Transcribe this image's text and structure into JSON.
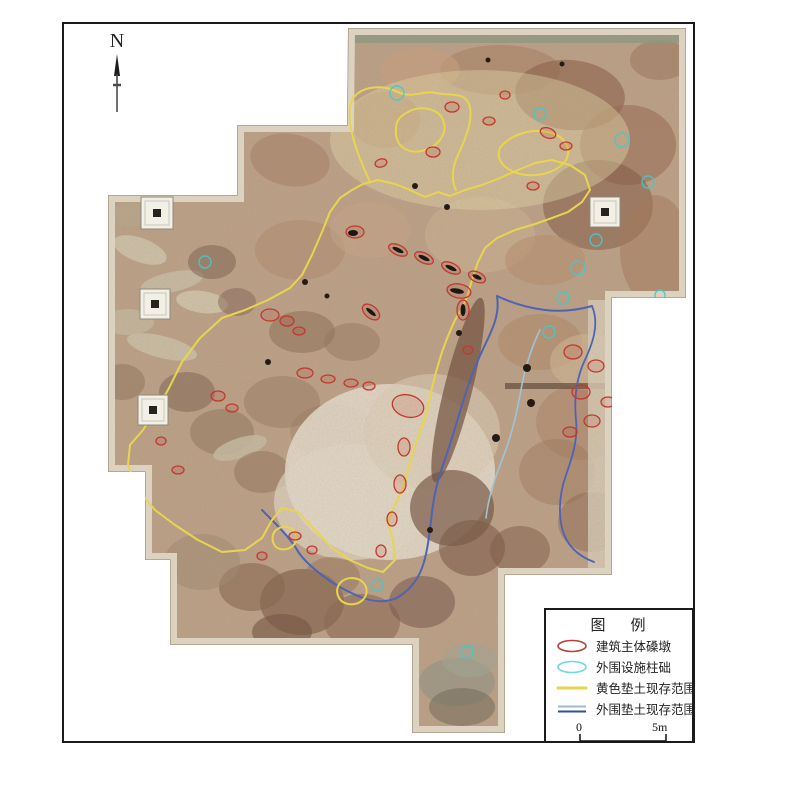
{
  "north": {
    "label": "N"
  },
  "legend": {
    "title": "图    例",
    "items": [
      {
        "name": "main-pier",
        "label": "建筑主体磉墩",
        "symbol": "ellipse",
        "stroke": "#b5413a"
      },
      {
        "name": "peripheral-column-base",
        "label": "外围设施柱础",
        "symbol": "ellipse",
        "stroke": "#6fd8dc"
      },
      {
        "name": "yellow-fill-extent",
        "label": "黄色垫土现存范围",
        "symbol": "line",
        "stroke": "#e8d44f"
      },
      {
        "name": "outer-fill-extent",
        "label": "外围垫土现存范围",
        "symbol": "double-line",
        "stroke": "#2d4f9e",
        "stroke2": "#9fb8cc"
      }
    ],
    "scale_start": "0",
    "scale_end": "5m"
  },
  "map": {
    "clip": "348,28 686,28 686,298 612,298 612,575 505,575 505,733 412,733 412,645 170,645 170,560 145,560 145,472 108,472 108,195 237,195 237,125 347,125",
    "base_fill": "#bda189",
    "edge_light": "#dcd2bf",
    "edge_dark": "#a79a83",
    "yellow": "#e8d44f",
    "red": "#c0392f",
    "cyan": "#45c8cc",
    "blobs": [
      [
        500,
        70,
        60,
        25,
        0,
        "#a87f61",
        0.55
      ],
      [
        570,
        95,
        55,
        35,
        5,
        "#8a5f48",
        0.6
      ],
      [
        628,
        145,
        48,
        40,
        0,
        "#97684e",
        0.55
      ],
      [
        598,
        205,
        55,
        45,
        0,
        "#7c523e",
        0.5
      ],
      [
        655,
        250,
        35,
        55,
        0,
        "#a37757",
        0.5
      ],
      [
        480,
        235,
        55,
        38,
        0,
        "#cbb391",
        0.6
      ],
      [
        420,
        70,
        40,
        22,
        0,
        "#c9a07e",
        0.6
      ],
      [
        385,
        120,
        35,
        28,
        0,
        "#b78a68",
        0.5
      ],
      [
        545,
        260,
        40,
        25,
        0,
        "#b68c6a",
        0.5
      ],
      [
        660,
        60,
        30,
        20,
        0,
        "#9a7258",
        0.5
      ],
      [
        290,
        160,
        40,
        26,
        10,
        "#a58064",
        0.55
      ],
      [
        140,
        250,
        28,
        12,
        20,
        "#cfc4ad",
        0.9
      ],
      [
        172,
        282,
        32,
        10,
        -12,
        "#c9bda6",
        0.9
      ],
      [
        202,
        302,
        26,
        11,
        8,
        "#d2c6ae",
        0.9
      ],
      [
        128,
        322,
        26,
        13,
        0,
        "#c4b79e",
        0.9
      ],
      [
        162,
        347,
        36,
        11,
        14,
        "#ccc0a8",
        0.9
      ],
      [
        212,
        262,
        24,
        17,
        0,
        "#7e6450",
        0.55
      ],
      [
        237,
        302,
        19,
        14,
        0,
        "#86695a",
        0.55
      ],
      [
        122,
        382,
        23,
        18,
        0,
        "#8a7158",
        0.5
      ],
      [
        187,
        392,
        28,
        20,
        0,
        "#79604e",
        0.5
      ],
      [
        222,
        432,
        32,
        23,
        0,
        "#8a6e57",
        0.45
      ],
      [
        240,
        448,
        28,
        10,
        -18,
        "#c8bca4",
        0.85
      ],
      [
        130,
        215,
        20,
        12,
        0,
        "#b7a78e",
        0.8
      ],
      [
        302,
        332,
        33,
        21,
        0,
        "#8a6a52",
        0.5
      ],
      [
        352,
        342,
        28,
        19,
        0,
        "#93745c",
        0.45
      ],
      [
        282,
        402,
        38,
        26,
        0,
        "#8f7058",
        0.4
      ],
      [
        332,
        432,
        42,
        28,
        0,
        "#97785f",
        0.35
      ],
      [
        262,
        472,
        28,
        21,
        0,
        "#8a6b54",
        0.45
      ],
      [
        390,
        472,
        105,
        88,
        0,
        "#e7ded0",
        0.85
      ],
      [
        352,
        502,
        78,
        58,
        0,
        "#e2d8c8",
        0.7
      ],
      [
        432,
        432,
        68,
        58,
        0,
        "#dccfb8",
        0.6
      ],
      [
        300,
        250,
        45,
        30,
        0,
        "#b08a6c",
        0.5
      ],
      [
        370,
        230,
        40,
        28,
        0,
        "#c7a887",
        0.5
      ],
      [
        458,
        390,
        14,
        95,
        14,
        "#6d4b3a",
        0.7
      ],
      [
        452,
        508,
        42,
        38,
        0,
        "#6f4e3c",
        0.65
      ],
      [
        472,
        548,
        33,
        28,
        0,
        "#7a5846",
        0.6
      ],
      [
        302,
        602,
        42,
        33,
        0,
        "#7d5c48",
        0.65
      ],
      [
        362,
        622,
        38,
        28,
        0,
        "#8a6752",
        0.6
      ],
      [
        252,
        587,
        33,
        24,
        0,
        "#86654f",
        0.6
      ],
      [
        422,
        602,
        33,
        26,
        0,
        "#77564a",
        0.55
      ],
      [
        332,
        577,
        28,
        20,
        0,
        "#94735a",
        0.5
      ],
      [
        202,
        562,
        38,
        28,
        0,
        "#a08a71",
        0.5
      ],
      [
        282,
        632,
        30,
        18,
        0,
        "#6f5240",
        0.6
      ],
      [
        540,
        342,
        42,
        28,
        0,
        "#b08663",
        0.5
      ],
      [
        582,
        422,
        46,
        38,
        0,
        "#a97f60",
        0.45
      ],
      [
        557,
        472,
        38,
        33,
        0,
        "#9c7458",
        0.4
      ],
      [
        592,
        522,
        34,
        30,
        0,
        "#8d6750",
        0.5
      ],
      [
        588,
        362,
        38,
        28,
        0,
        "#d3bb97",
        0.55
      ],
      [
        520,
        550,
        30,
        24,
        0,
        "#7b5a46",
        0.5
      ],
      [
        457,
        682,
        38,
        24,
        0,
        "#8f9486",
        0.6
      ],
      [
        462,
        707,
        33,
        19,
        0,
        "#6f6a58",
        0.55
      ],
      [
        470,
        660,
        28,
        17,
        0,
        "#a3a896",
        0.55
      ],
      [
        480,
        140,
        150,
        70,
        0,
        "#e3d6a8",
        0.45
      ]
    ],
    "rects": [
      [
        348,
        28,
        338,
        15,
        "#8f9a85",
        0.8
      ],
      [
        505,
        383,
        106,
        6,
        "#5f4636",
        0.7
      ],
      [
        588,
        300,
        24,
        272,
        "#d9cfbc",
        0.8
      ]
    ],
    "yellow_paths": [
      "M352,190 L340,198 L330,212 L322,232 L312,255 L302,275 L290,288 L268,300 L245,310 L222,318 L200,338 L182,362 L168,390 L153,415 L143,430 L130,445 L128,465 L138,490 L155,510 L175,525 L198,540 L222,552 L245,550 L262,538 L272,520 L282,508 L298,512 L315,530 L332,548 L350,560 L368,568 L383,572 L395,560 L393,540 L388,522 L395,505 L403,488 L408,470 L413,452 L420,432 L427,412 L431,392 L436,372 L442,352 L448,336 L455,320 L462,308 L467,297 L472,280 L478,262 L485,248 L497,238 L515,230 L535,224 L552,218 L568,212 L582,202 L590,190 L585,175 L570,165 L552,160 L535,163 L518,170 L500,178 L482,185 L465,190 L450,196 L438,192 L425,197 L410,190 L395,184 L378,180 L363,184 Z",
      "M370,182 C355,150 345,118 352,100 C360,86 382,84 398,92 C412,99 422,90 436,93 C452,96 464,92 469,104 C474,118 466,138 458,155 C451,170 452,182 456,190",
      "M408,112 C420,105 438,108 443,120 C448,132 440,145 425,150 C410,155 398,148 396,135 C395,122 398,117 408,112 Z",
      "M500,148 C510,135 530,128 548,132 C565,136 572,148 566,160 C558,172 538,178 520,174 C505,170 495,160 500,148 Z",
      "M340,583 C348,575 362,577 366,587 C369,597 360,606 348,604 C338,602 334,591 340,583 Z",
      "M276,530 C284,524 294,527 296,535 C298,544 290,551 280,549 C272,547 270,536 276,530 Z"
    ],
    "blue_paths": [
      {
        "d": "M497,296 C500,315 492,330 485,345 C475,365 468,385 462,405 C456,425 450,445 444,462 C438,478 434,495 432,512 C430,530 428,548 424,562 C420,576 412,588 400,596 C388,604 372,602 358,596 C344,590 330,582 318,572 C308,564 300,556 296,548 C288,536 276,524 262,510",
        "color": "#4f63b5",
        "w": 2
      },
      {
        "d": "M497,296 C512,303 528,308 545,310 C562,312 578,310 592,306",
        "color": "#4f63b5",
        "w": 2
      },
      {
        "d": "M592,306 C600,325 592,345 584,362 C576,380 574,400 576,420 C578,440 572,458 566,475 C560,492 558,510 562,528 C566,545 578,556 594,562",
        "color": "#4f63b5",
        "w": 1.8
      },
      {
        "d": "M540,330 C530,350 524,372 520,395 C516,418 510,440 502,460 C494,480 488,500 486,518",
        "color": "#9fc4d6",
        "w": 1.6
      }
    ],
    "red_ellipses": [
      [
        452,
        107,
        7,
        5,
        0
      ],
      [
        489,
        121,
        6,
        4,
        0
      ],
      [
        548,
        133,
        8,
        5,
        20
      ],
      [
        566,
        146,
        6,
        4,
        0
      ],
      [
        433,
        152,
        7,
        5,
        0
      ],
      [
        381,
        163,
        6,
        4,
        -15
      ],
      [
        355,
        232,
        9,
        6,
        0
      ],
      [
        398,
        250,
        10,
        5,
        25
      ],
      [
        424,
        258,
        10,
        5,
        25
      ],
      [
        451,
        268,
        10,
        5,
        25
      ],
      [
        477,
        277,
        9,
        5,
        25
      ],
      [
        459,
        291,
        12,
        7,
        10
      ],
      [
        371,
        312,
        10,
        6,
        40
      ],
      [
        463,
        310,
        6,
        10,
        0
      ],
      [
        270,
        315,
        9,
        6,
        0
      ],
      [
        287,
        321,
        7,
        5,
        0
      ],
      [
        299,
        331,
        6,
        4,
        0
      ],
      [
        305,
        373,
        8,
        5,
        0
      ],
      [
        328,
        379,
        7,
        4,
        0
      ],
      [
        351,
        383,
        7,
        4,
        0
      ],
      [
        369,
        386,
        6,
        4,
        0
      ],
      [
        150,
        420,
        6,
        4,
        0
      ],
      [
        161,
        441,
        5,
        4,
        0
      ],
      [
        218,
        396,
        7,
        5,
        0
      ],
      [
        232,
        408,
        6,
        4,
        0
      ],
      [
        408,
        406,
        16,
        11,
        15
      ],
      [
        468,
        350,
        5,
        4,
        0
      ],
      [
        404,
        447,
        6,
        9,
        0
      ],
      [
        400,
        484,
        6,
        9,
        0
      ],
      [
        392,
        519,
        5,
        7,
        0
      ],
      [
        381,
        551,
        5,
        6,
        0
      ],
      [
        573,
        352,
        9,
        7,
        0
      ],
      [
        596,
        366,
        8,
        6,
        0
      ],
      [
        581,
        392,
        9,
        7,
        0
      ],
      [
        608,
        402,
        7,
        5,
        0
      ],
      [
        592,
        421,
        8,
        6,
        0
      ],
      [
        570,
        432,
        7,
        5,
        0
      ],
      [
        295,
        536,
        6,
        4,
        0
      ],
      [
        312,
        550,
        5,
        4,
        0
      ],
      [
        262,
        556,
        5,
        4,
        0
      ],
      [
        178,
        470,
        6,
        4,
        0
      ],
      [
        533,
        186,
        6,
        4,
        0
      ],
      [
        505,
        95,
        5,
        4,
        0
      ]
    ],
    "black_slots": [
      [
        398,
        250,
        6,
        2,
        25
      ],
      [
        424,
        258,
        6,
        2,
        25
      ],
      [
        451,
        268,
        6,
        2,
        25
      ],
      [
        477,
        277,
        5,
        2,
        25
      ],
      [
        457,
        291,
        7,
        2.5,
        10
      ],
      [
        371,
        312,
        6,
        2,
        40
      ],
      [
        463,
        310,
        2.5,
        6,
        0
      ],
      [
        353,
        233,
        5,
        3,
        0
      ]
    ],
    "black_dots": [
      [
        415,
        186,
        3
      ],
      [
        447,
        207,
        3
      ],
      [
        459,
        333,
        3
      ],
      [
        527,
        368,
        4
      ],
      [
        531,
        403,
        4
      ],
      [
        496,
        438,
        4
      ],
      [
        305,
        282,
        3
      ],
      [
        327,
        296,
        2.5
      ],
      [
        430,
        530,
        3
      ],
      [
        268,
        362,
        3
      ],
      [
        488,
        60,
        2.5
      ],
      [
        562,
        64,
        2.5
      ]
    ],
    "cyan_circles": [
      [
        397,
        93,
        7
      ],
      [
        540,
        114,
        6
      ],
      [
        622,
        140,
        7
      ],
      [
        648,
        182,
        6
      ],
      [
        596,
        240,
        6
      ],
      [
        578,
        268,
        7
      ],
      [
        563,
        298,
        6
      ],
      [
        549,
        332,
        6
      ],
      [
        205,
        262,
        6
      ],
      [
        377,
        585,
        6
      ],
      [
        467,
        652,
        6
      ],
      [
        660,
        295,
        5
      ]
    ],
    "column_bases": [
      [
        157,
        213,
        16
      ],
      [
        155,
        304,
        15
      ],
      [
        153,
        410,
        15
      ],
      [
        605,
        212,
        15
      ]
    ]
  }
}
